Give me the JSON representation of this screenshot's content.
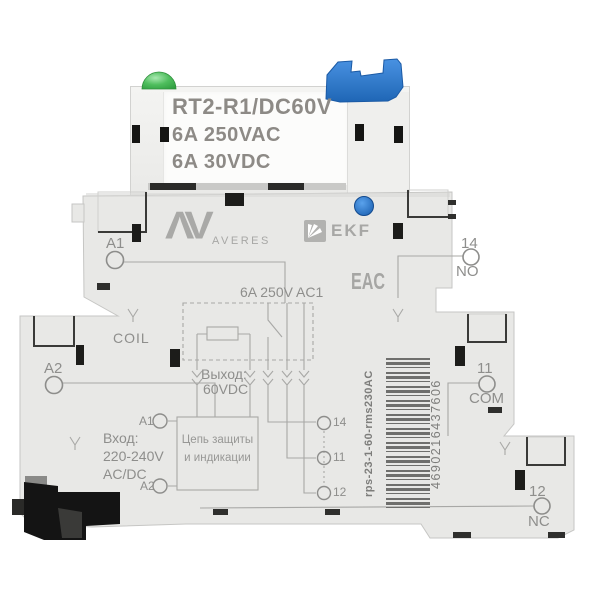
{
  "relay": {
    "model": "RT2-R1/DC60V",
    "rating_ac": "6A 250VAC",
    "rating_dc": "6A 30VDC"
  },
  "branding": {
    "monogram": "ΛV",
    "name": "AVERES",
    "ekf": "EKF",
    "eac": "EAC"
  },
  "terminals": {
    "a1": "A1",
    "coil": "COIL",
    "a2": "A2",
    "t14": "14",
    "no": "NO",
    "t11": "11",
    "com": "COM",
    "t12": "12",
    "nc": "NC"
  },
  "schematic": {
    "contact_rating": "6A 250V AC1",
    "output_label": "Выход:",
    "output_value": "60VDC",
    "input_label": "Вход:",
    "input_voltage": "220-240V",
    "input_type": "AC/DC",
    "protection_line1": "Цепь защиты",
    "protection_line2": "и индикации",
    "pin_a1": "A1",
    "pin_a2": "A2",
    "pin_14": "14",
    "pin_11": "11",
    "pin_12": "12"
  },
  "barcode": {
    "sku": "rps-23-1-60-rms230AC",
    "ean": "4690216437606"
  },
  "colors": {
    "body": "#e8e8e6",
    "clip_blue": "#2e7bd0",
    "led_green": "#3fae4c",
    "button_blue": "#2470c8",
    "print_gray": "#8e8e8c"
  }
}
